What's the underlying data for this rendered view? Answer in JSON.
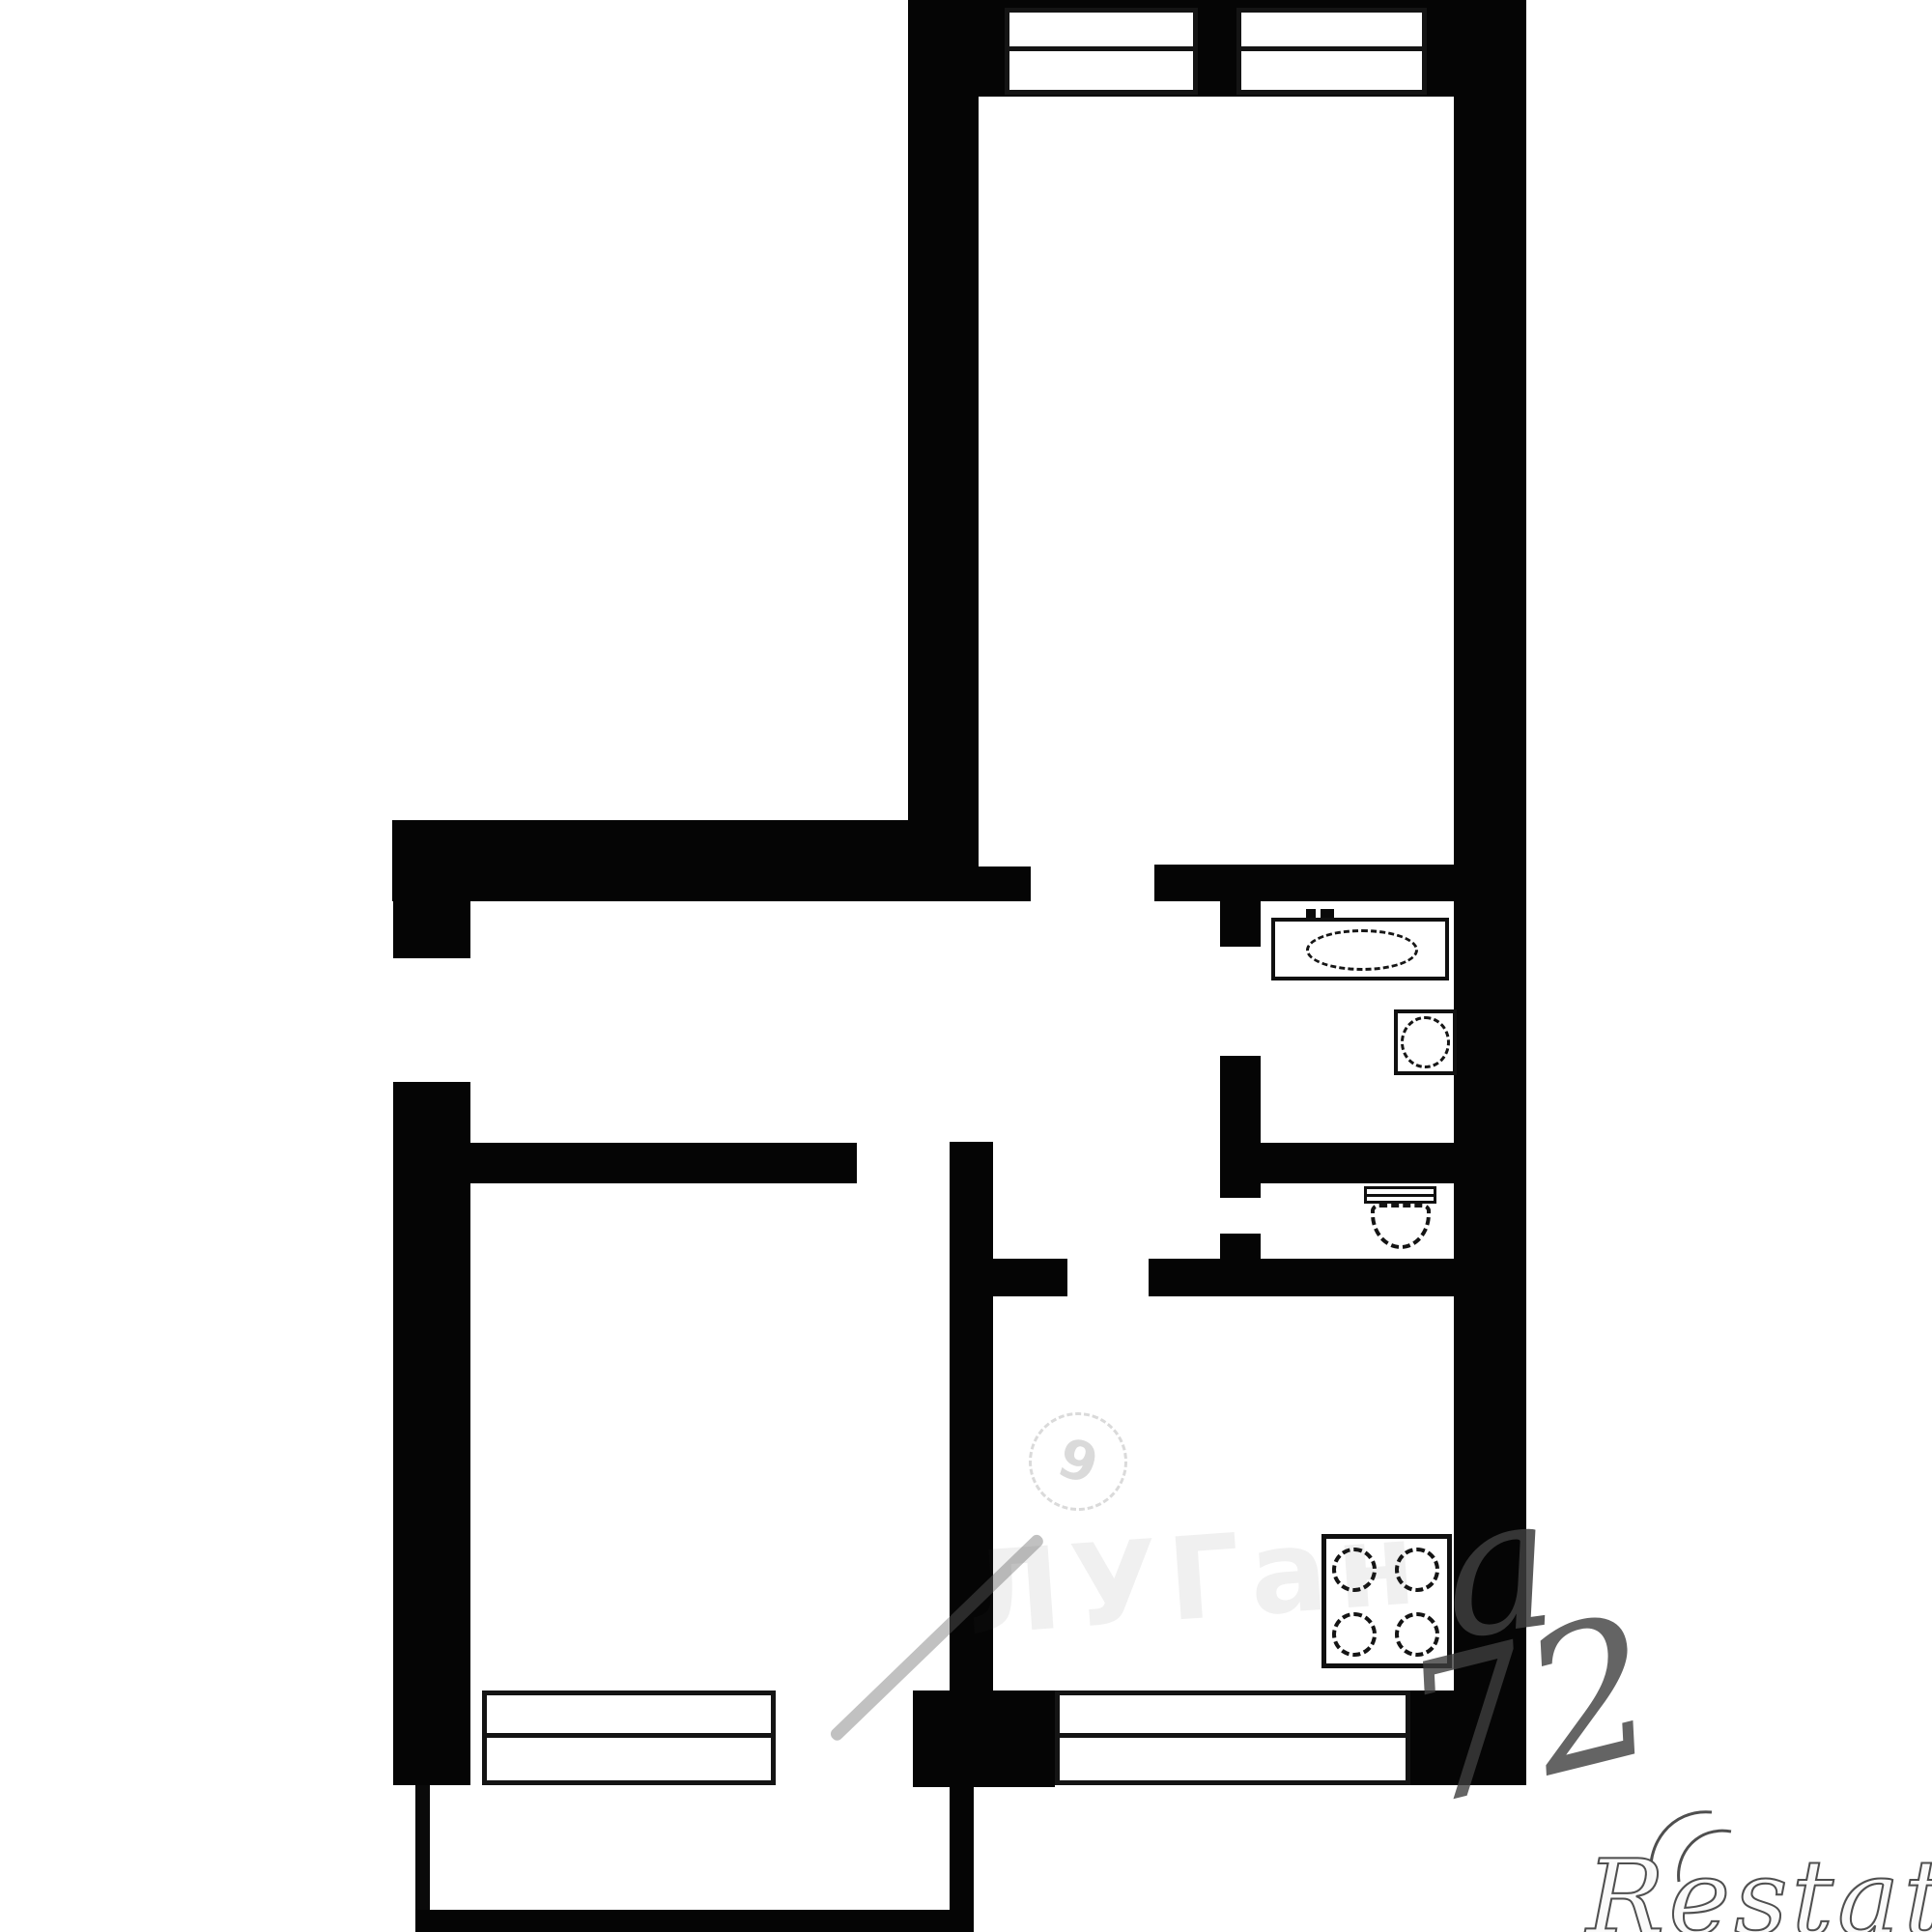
{
  "page": {
    "background_color": "#ffffff",
    "wall_color": "#050505",
    "content": "black-and-white apartment floor plan"
  },
  "plan": {
    "fixtures": [
      {
        "name": "bathtub"
      },
      {
        "name": "sink"
      },
      {
        "name": "toilet"
      },
      {
        "name": "stove",
        "burners": 4
      }
    ],
    "window_count": 4,
    "door_openings": 7
  },
  "watermarks": {
    "logo_digit": "9",
    "agency_text": "ЛУГан",
    "letter_overlay": "а",
    "digits_overlay": "72",
    "brand": "Restate"
  }
}
